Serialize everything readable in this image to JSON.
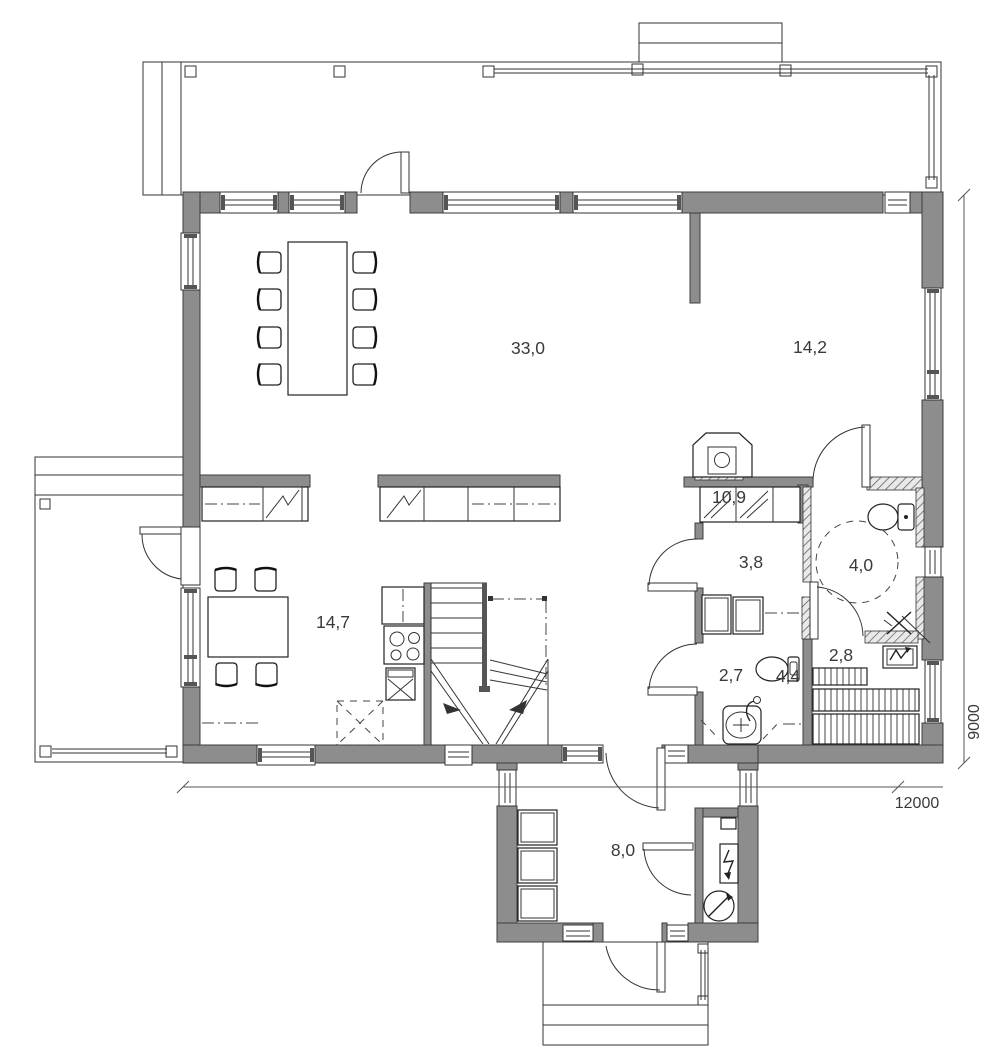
{
  "plan": {
    "rooms": [
      {
        "name": "living-room",
        "area": "33,0"
      },
      {
        "name": "bedroom",
        "area": "14,2"
      },
      {
        "name": "kitchen-dining",
        "area": "14,7"
      },
      {
        "name": "hall",
        "area": "10,9"
      },
      {
        "name": "closet",
        "area": "3,8"
      },
      {
        "name": "bathroom",
        "area": "4,0"
      },
      {
        "name": "wc",
        "area": "2,7"
      },
      {
        "name": "washroom",
        "area": "4,4"
      },
      {
        "name": "sauna",
        "area": "2,8"
      },
      {
        "name": "entrance",
        "area": "8,0"
      }
    ],
    "dimensions": {
      "width": "12000",
      "height": "9000"
    },
    "colors": {
      "wall": "#8d8d8d",
      "line": "#333333",
      "background": "#ffffff"
    }
  }
}
